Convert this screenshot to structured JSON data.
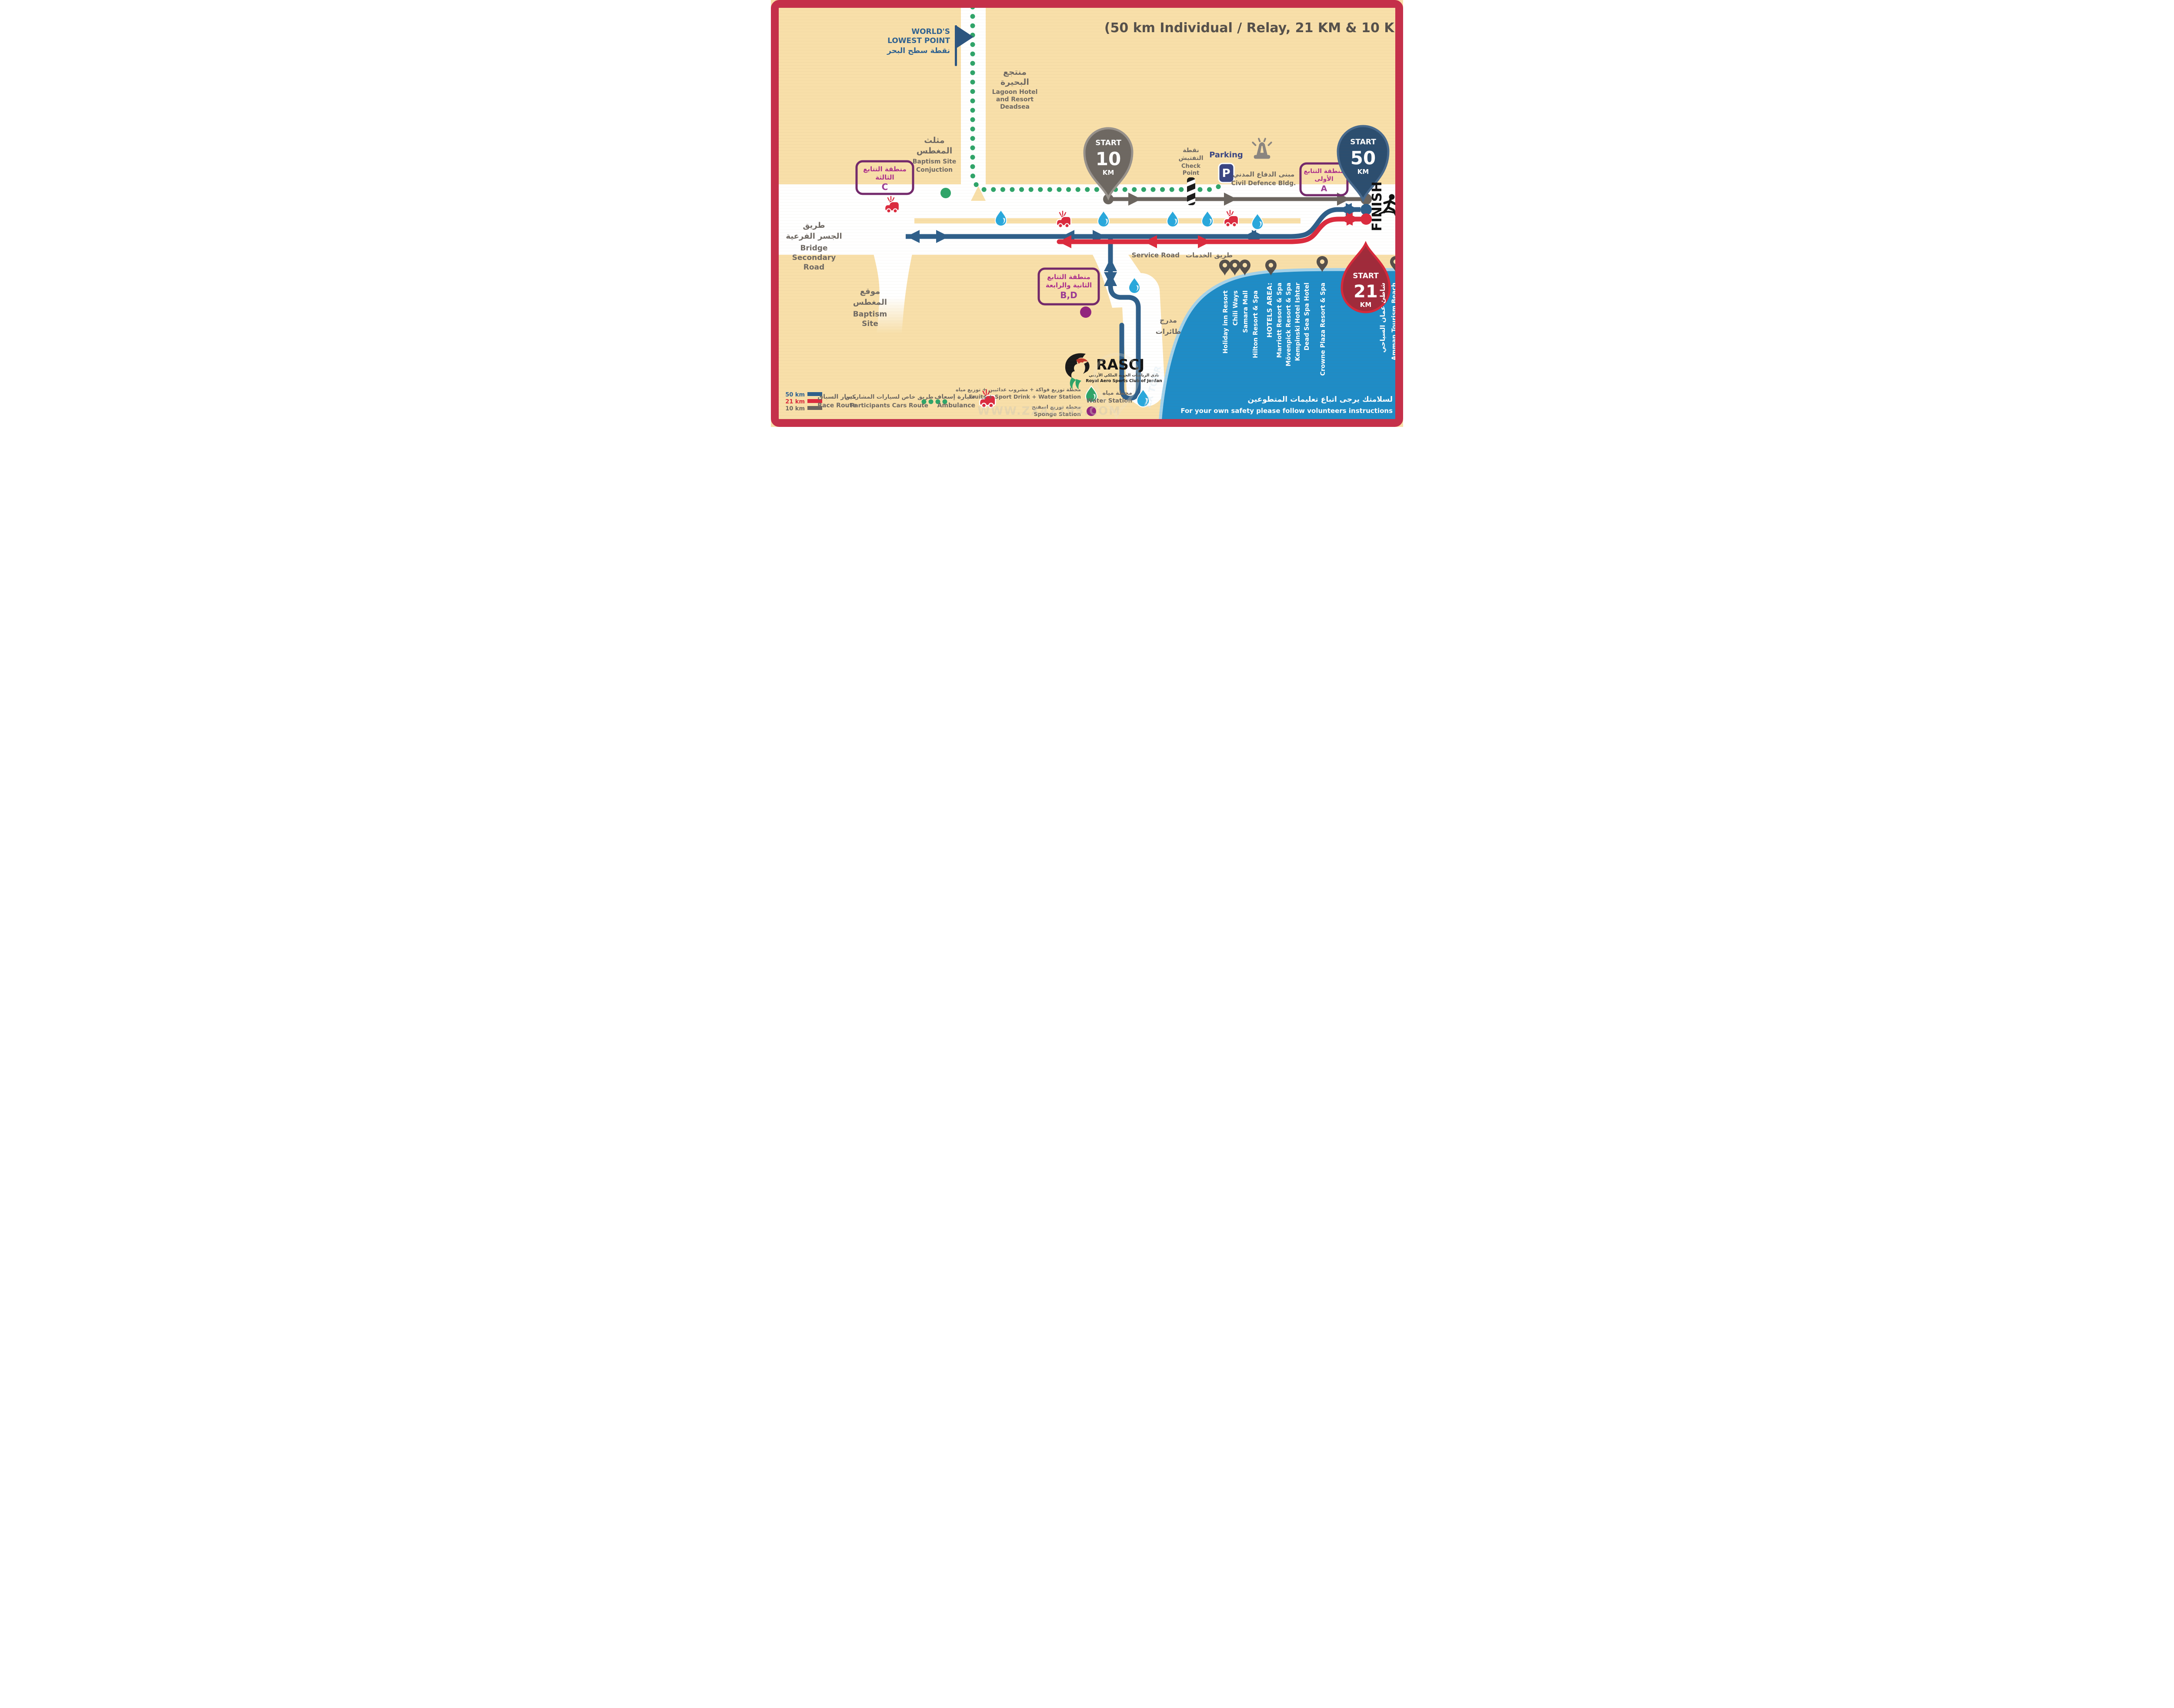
{
  "title": "(50 km Individual / Relay, 21 KM & 10 KM)",
  "watermark": {
    "url": "WWW.ZX42195.COM",
    "tour": "ZX TOUR"
  },
  "colors": {
    "background": "#F8DFA9",
    "frame": "#C5304A",
    "route_50km": "#2F5F8A",
    "route_21km": "#DB2B3E",
    "route_10km": "#6B655F",
    "cars_route_dots": "#2FA469",
    "sea": "#1F8CC6",
    "shoreline": "#A5D2E9",
    "zone_border": "#73286B",
    "zone_text": "#AC2F8C",
    "water_drop": "#29A8DC",
    "sponge": "#92257E",
    "parking_navy": "#3A4583"
  },
  "landmarks": {
    "worlds_lowest_point": {
      "l1": "WORLD'S",
      "l2": "LOWEST POINT",
      "ar": "نقطة سطح البحر"
    },
    "lagoon_hotel": {
      "ar1": "منتجع",
      "ar2": "البحيرة",
      "en1": "Lagoon Hotel",
      "en2": "and Resort",
      "en3": "Deadsea"
    },
    "baptism_conjunction": {
      "ar1": "مثلث",
      "ar2": "المغطس",
      "en1": "Baptism Site",
      "en2": "Conjuction"
    },
    "bridge_road": {
      "ar1": "طريق",
      "ar2": "الجسر الفرعية",
      "en1": "Bridge",
      "en2": "Secondary",
      "en3": "Road"
    },
    "baptism_site": {
      "ar1": "موقع",
      "ar2": "المغطس",
      "en1": "Baptism",
      "en2": "Site"
    },
    "service_road": {
      "en": "Service Road",
      "ar": "طريق الخدمات"
    },
    "runway": {
      "ar1": "مدرج",
      "ar2": "طائرات"
    },
    "check_point": {
      "ar1": "نقطة",
      "ar2": "التفتيش",
      "en1": "Check",
      "en2": "Point"
    },
    "parking": {
      "label": "Parking",
      "icon_letter": "P"
    },
    "civil_defence": {
      "ar": "مبنى الدفاع المدني",
      "en": "Civil Defence Bldg."
    }
  },
  "markers": {
    "start_10": {
      "start": "START",
      "distance": "10",
      "unit": "KM"
    },
    "start_50": {
      "start": "START",
      "distance": "50",
      "unit": "KM"
    },
    "start_21": {
      "start": "START",
      "distance": "21",
      "unit": "KM"
    },
    "finish": {
      "label": "FINISH"
    }
  },
  "relay_zones": {
    "a": {
      "l1": "منطقة التتابع",
      "l2": "الأولى",
      "letter": "A"
    },
    "bd": {
      "l1": "منطقة التتابع",
      "l2": "الثانية والرابعة",
      "letter": "B,D"
    },
    "c": {
      "l1": "منطقة التتابع",
      "l2": "الثالثة",
      "letter": "C"
    }
  },
  "hotels": [
    {
      "name": "Holiday inn Resort"
    },
    {
      "name": "Chili Ways"
    },
    {
      "name": "Samara Mall"
    },
    {
      "name": "Hilton Resort & Spa"
    },
    {
      "name": "HOTELS AREA:"
    },
    {
      "name": "Marriott Resort & Spa"
    },
    {
      "name": "Mövenpick Resort & Spa"
    },
    {
      "name": "Kempinski Hotel Ishtar"
    },
    {
      "name": "Dead Sea Spa Hotel"
    },
    {
      "name": "Crowne Plaza Resort & Spa"
    },
    {
      "name": "شاطئ عمان السياحي"
    },
    {
      "name": "Amman Tourism Beach"
    }
  ],
  "safety": {
    "ar": "لسلامتك يرجى اتباع تعليمات المتطوعين",
    "en": "For your own safety please follow volunteers instructions"
  },
  "logo": {
    "abbr": "RASCJ",
    "ar": "نادي الرياضات الجوية الملكي الأردني",
    "en": "Royal Aero Sports Club of Jordan"
  },
  "legend": {
    "route_lines": [
      {
        "label": "50 km"
      },
      {
        "label": "21 km"
      },
      {
        "label": "10 km"
      }
    ],
    "race_route": {
      "ar": "مسار السباق",
      "en": "Race Route"
    },
    "cars_route": {
      "ar": "طريق خاص لسيارات المشاركين",
      "en": "Participants Cars Route"
    },
    "ambulance": {
      "ar": "سيارة إسعاف",
      "en": "Ambulance"
    },
    "fruits_station": {
      "ar": "محطة توزيع فواكة + مشروب عدائيين + توزيع مياه",
      "en": "Fruits + Sport Drink + Water Station"
    },
    "sponge_station": {
      "ar": "محطة توزيع اسفنج",
      "en": "Sponge Station"
    },
    "water_station": {
      "ar": "محطة مياه",
      "en": "Water Station"
    }
  }
}
